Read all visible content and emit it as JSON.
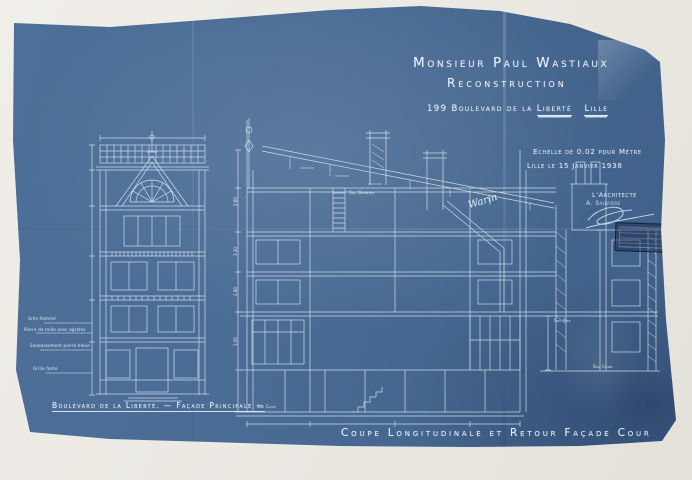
{
  "colors": {
    "scan_background": "#eeebe5",
    "blueprint_blue": "#496c95",
    "line_white": "#e8eff9",
    "stamp_ink": "#1c2945"
  },
  "title_block": {
    "owner": "Monsieur Paul Wastiaux",
    "subtitle": "Reconstruction",
    "address_prefix": "199 Boulevard de la ",
    "address_emph": "Liberté",
    "city": "Lille"
  },
  "info_block": {
    "scale_note": "Echelle de 0.02 pour Mètre",
    "place_date": "Lille le 15 Janvier 1938",
    "architect_label": "L'Architecte",
    "architect_name": "A. Sauvière",
    "handwritten_signature": "Warin"
  },
  "captions": {
    "facade_caption": "Boulevard de la Liberté. — Façade Principale —",
    "section_caption": "Coupe Longitudinale et Retour Façade Cour"
  },
  "drawing_labels": {
    "sol_grenier": "Sol Grenier",
    "sol_rez": "Sol Rez",
    "sol_cour": "Sol Cour",
    "sol_cave": "Sol Cave"
  },
  "annotations_left": [
    "Grès flammé",
    "Pierre de taille avec agrafes",
    "Soubassement pierre bleue",
    "Grille fonte"
  ],
  "dimensions": [
    "2.60",
    "3.20",
    "2.80",
    "1.00"
  ]
}
